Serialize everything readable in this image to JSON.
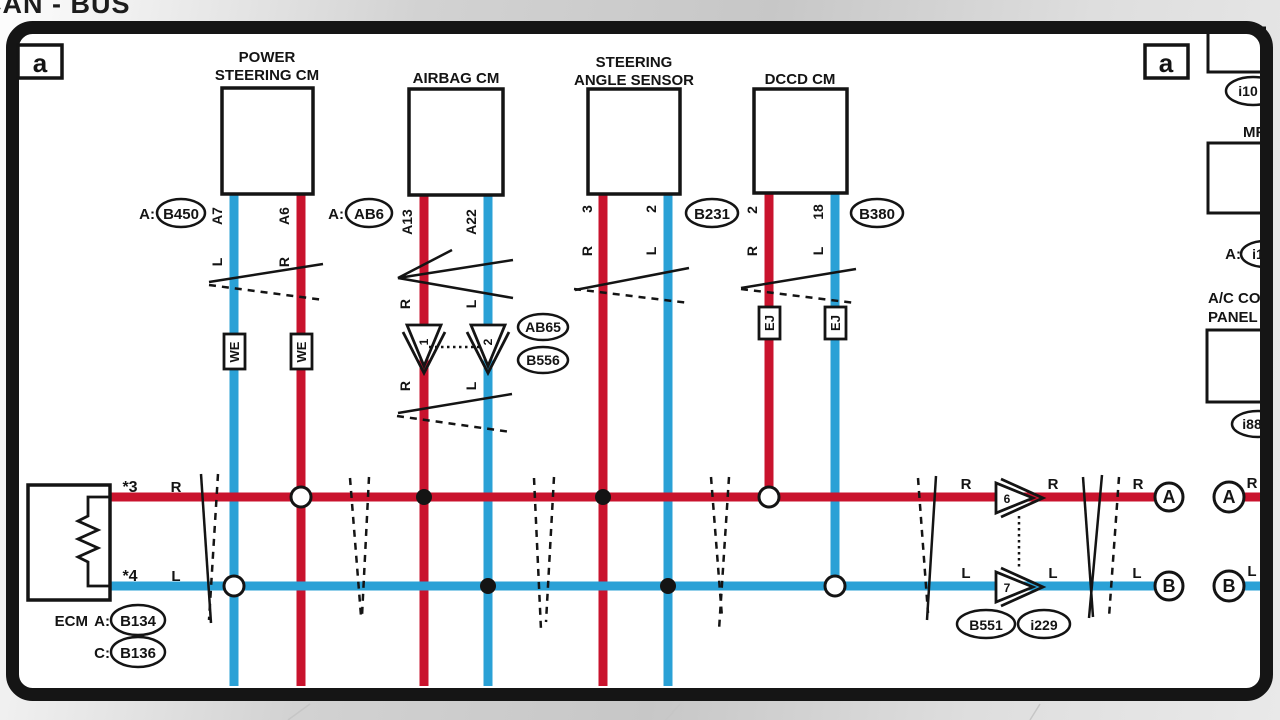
{
  "title": "CAN - BUS",
  "colors": {
    "can_high_red": "#c9132d",
    "can_low_blue": "#2aa1d6",
    "line": "#141414"
  },
  "frame": {
    "ref_left": "a",
    "ref_right": "a"
  },
  "ecm": {
    "name": "ECM",
    "conn_a_prefix": "A:",
    "conn_a": "B134",
    "conn_c_prefix": "C:",
    "conn_c": "B136",
    "pin_high": "*3",
    "wire_high": "R",
    "pin_low": "*4",
    "wire_low": "L"
  },
  "power_steering": {
    "name_1": "POWER",
    "name_2": "STEERING CM",
    "conn_prefix": "A:",
    "conn": "B450",
    "pin_low": "A7",
    "wire_low": "L",
    "pin_high": "A6",
    "wire_high": "R",
    "splice": "WE"
  },
  "airbag": {
    "name": "AIRBAG CM",
    "conn_prefix": "A:",
    "conn": "AB6",
    "pin_high": "A13",
    "wire_high": "R",
    "pin_low": "A22",
    "wire_low": "L",
    "inline_high": "1",
    "inline_low": "2",
    "inline_conn_1": "AB65",
    "inline_conn_2": "B556"
  },
  "steering_angle": {
    "name_1": "STEERING",
    "name_2": "ANGLE SENSOR",
    "conn": "B231",
    "pin_high": "3",
    "wire_high": "R",
    "pin_low": "2",
    "wire_low": "L"
  },
  "dccd": {
    "name": "DCCD CM",
    "conn": "B380",
    "pin_high": "2",
    "wire_high": "R",
    "pin_low": "18",
    "wire_low": "L",
    "splice": "EJ"
  },
  "bus": {
    "label_high": "R",
    "label_low": "L",
    "inline_high": "6",
    "inline_low": "7",
    "conn_1": "B551",
    "conn_2": "i229",
    "terminal_high": "A",
    "terminal_low": "B"
  },
  "right_column": {
    "conn_top": "i10",
    "mfd": "MFD",
    "mfd_prefix": "A:",
    "mfd_conn": "i1",
    "ac_1": "A/C CONT",
    "ac_2": "PANEL",
    "ac_conn": "i88"
  }
}
